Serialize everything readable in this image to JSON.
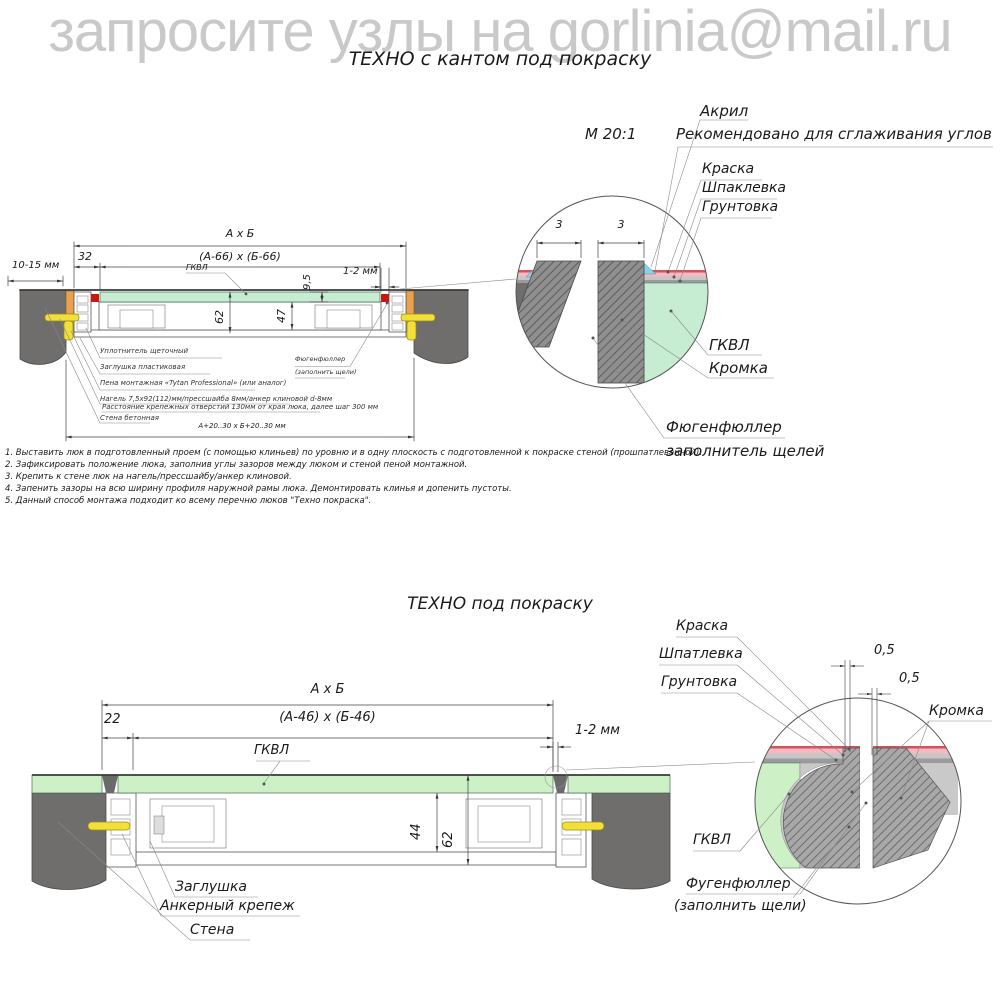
{
  "watermark": "запросите узлы на gorlinia@mail.ru",
  "colors": {
    "wall": "#6f6e6c",
    "gkvl_green_top": "#c6ecd2",
    "gkvl_green_bottom": "#cef0c6",
    "wedge_orange": "#e7a14f",
    "anchor_yellow": "#f2df39",
    "seal_red": "#c81910",
    "paint_pink": "#f3bac1",
    "paint_red_line": "#d9505b",
    "acryl_blue": "#8ed2ea",
    "putty_gray": "#c6c6c6",
    "primer_gray": "#9b9b9b",
    "watermark_gray": "#c9c9c9"
  },
  "top": {
    "title": "ТЕХНО с кантом под покраску",
    "scale_label": "М 20:1",
    "dims": {
      "axb": "А х Б",
      "inner": "(А-66) х (Б-66)",
      "d32": "32",
      "d10_15": "10-15 мм",
      "gkvl": "ГКВЛ",
      "d9_5": "9,5",
      "d1_2": "1-2 мм",
      "d62": "62",
      "d47": "47",
      "opening": "А+20..30 х Б+20..30 мм"
    },
    "labels": {
      "seal": "Уплотнитель щеточный",
      "plug": "Заглушка пластиковая",
      "foam": "Пена монтажная «Tytan Professional» (или аналог)",
      "dowel": "Нагель 7,5х92(112)мм/прессшайба 8мм/анкер клиновой d-8мм",
      "spacing": "Расстояние крепежных отверстий 130мм от края люка, далее шаг 300 мм",
      "wall": "Стена бетонная",
      "filler_line1": "Фюгенфюллер",
      "filler_line2": "(заполнить щели)"
    },
    "detail": {
      "d3_left": "3",
      "d3_right": "3",
      "acryl": "Акрил",
      "acryl_note": "Рекомендовано для сглаживания углов",
      "paint": "Краска",
      "putty": "Шпаклевка",
      "primer": "Грунтовка",
      "gkvl": "ГКВЛ",
      "edge": "Кромка",
      "filler_line1": "Фюгенфюллер",
      "filler_line2": "заполнитель щелей"
    },
    "notes": [
      "1. Выставить люк в подготовленный проем (с помощью клиньев) по уровню и в одну плоскость с подготовленной к покраске стеной (прошпатлеванной).",
      "2. Зафиксировать положение люка, заполнив углы зазоров между люком и стеной пеной монтажной.",
      "3. Крепить к стене люк на нагель/прессшайбу/анкер клиновой.",
      "4. Запенить зазоры на всю ширину профиля наружной рамы люка. Демонтировать клинья и допенить пустоты.",
      "5. Данный способ монтажа подходит ко всему перечню люков \"Техно покраска\"."
    ]
  },
  "bottom": {
    "title": "ТЕХНО под покраску",
    "dims": {
      "axb": "А х Б",
      "inner": "(А-46) х (Б-46)",
      "d22": "22",
      "d1_2": "1-2 мм",
      "gkvl": "ГКВЛ",
      "d44": "44",
      "d62": "62"
    },
    "labels": {
      "plug": "Заглушка",
      "anchor": "Анкерный крепеж",
      "wall": "Стена"
    },
    "detail": {
      "paint": "Краска",
      "putty": "Шпатлевка",
      "primer": "Грунтовка",
      "d05_a": "0,5",
      "d05_b": "0,5",
      "edge": "Кромка",
      "gkvl": "ГКВЛ",
      "filler_line1": "Фугенфюллер",
      "filler_line2": "(заполнить щели)"
    }
  }
}
